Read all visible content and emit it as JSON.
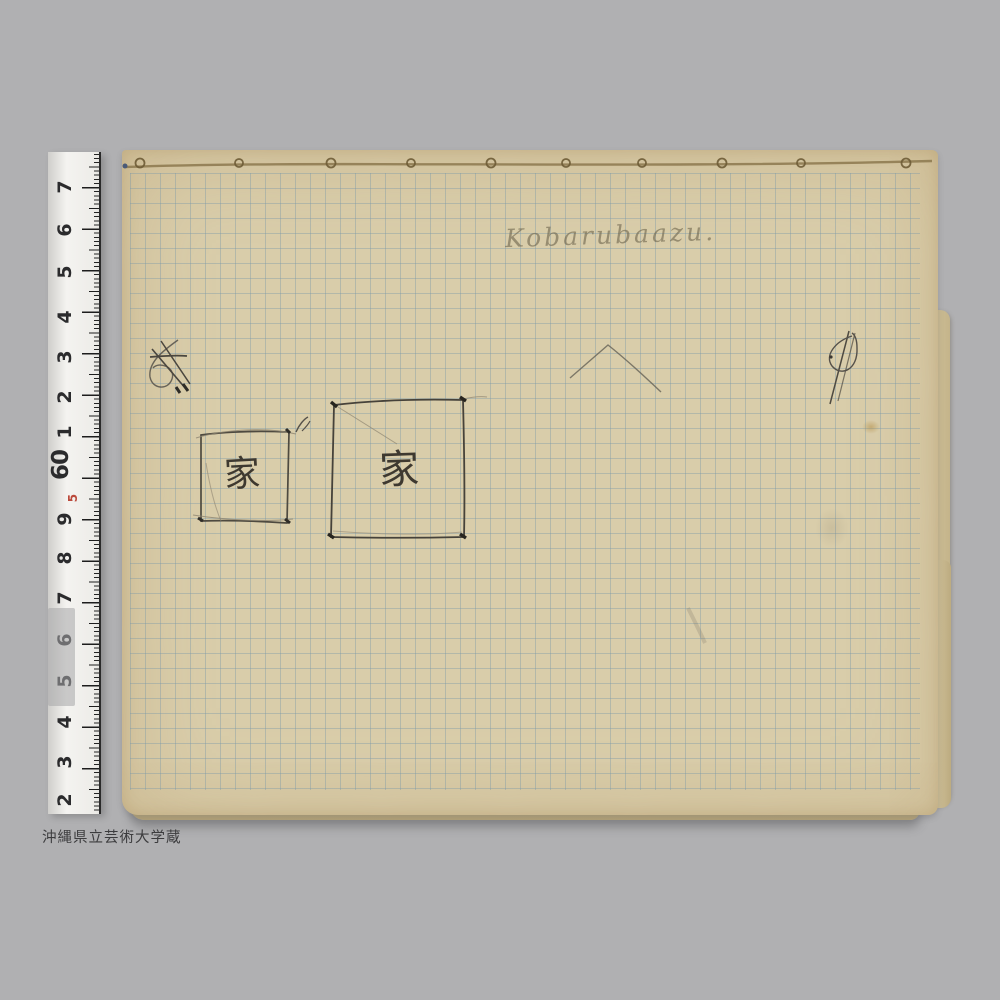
{
  "caption": "沖縄県立芸術大学蔵",
  "notebook": {
    "handwriting_title": "Kobarubaazu.",
    "small_square_label": "家",
    "large_square_label": "家"
  },
  "ruler": {
    "numbers": [
      "7",
      "6",
      "5",
      "4",
      "3",
      "2",
      "1",
      "60",
      "5",
      "9",
      "8",
      "7",
      "6",
      "5",
      "4",
      "3",
      "2"
    ],
    "highlighted_number": "60",
    "red_number": "5"
  },
  "colors": {
    "background": "#b0b0b2",
    "paper": "#d9cdaa",
    "grid_line": "#7a98a8",
    "pencil": "#4a463c",
    "ruler_red": "#bb4a3c"
  }
}
